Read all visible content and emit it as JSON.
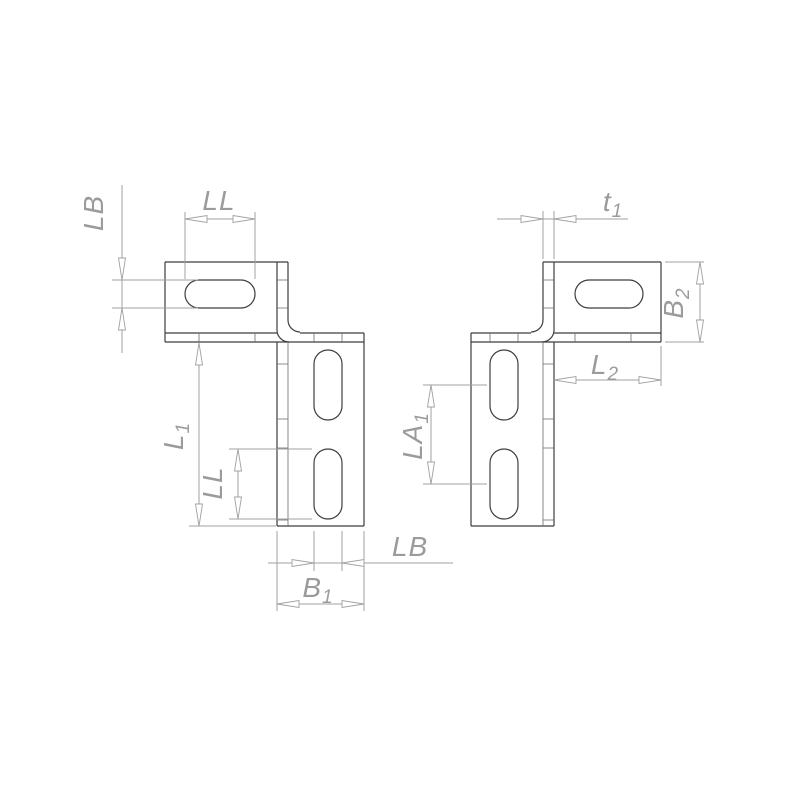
{
  "drawing_title": "Z-bracket with slotted holes - dimensioned technical drawing, two mirrored variants",
  "colors": {
    "background": "#ffffff",
    "part_line": "#3d3d3d",
    "inner_line": "#6a6a6a",
    "dim_line": "#a0a0a0",
    "label": "#9b9b9b",
    "arrow_fill": "#ffffff"
  },
  "figures": {
    "left_bracket": {
      "name": "left bracket (slot dimensions and leg length)",
      "dimensions": {
        "slot_width_top": {
          "base": "LB",
          "sub": ""
        },
        "slot_length_top": {
          "base": "LL",
          "sub": ""
        },
        "leg_length": {
          "base": "L",
          "sub": "1"
        },
        "slot_length_side": {
          "base": "LL",
          "sub": ""
        },
        "leg_width": {
          "base": "B",
          "sub": "1"
        },
        "slot_width_bottom": {
          "base": "LB",
          "sub": ""
        }
      }
    },
    "right_bracket": {
      "name": "right bracket (thickness, flange and hole spacing)",
      "dimensions": {
        "thickness": {
          "base": "t",
          "sub": "1"
        },
        "flange_width": {
          "base": "B",
          "sub": "2"
        },
        "flange_length": {
          "base": "L",
          "sub": "2"
        },
        "slot_spacing": {
          "base": "LA",
          "sub": "1"
        }
      }
    }
  }
}
